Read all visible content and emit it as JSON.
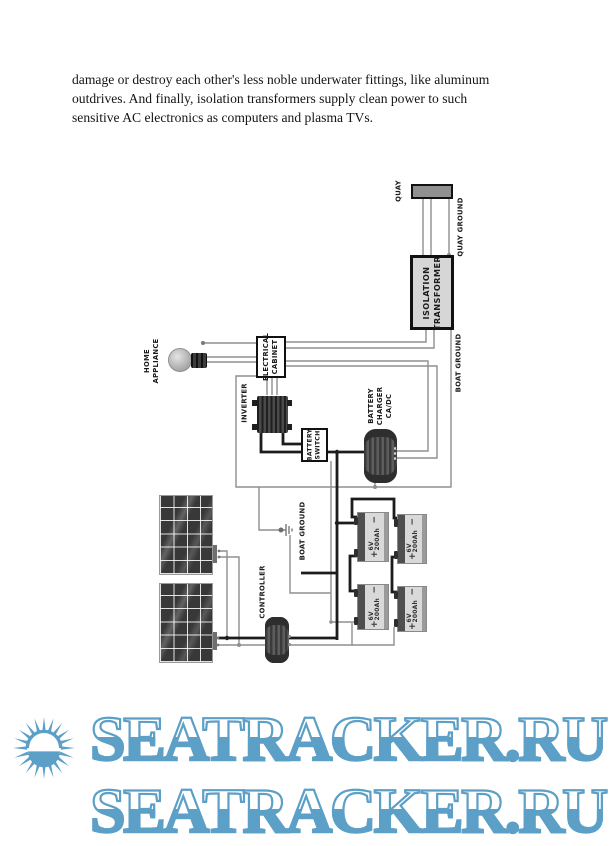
{
  "document": {
    "paragraph_lines": [
      "damage or destroy each other's less noble underwater fittings, like aluminum",
      "outdrives. And finally, isolation transformers supply clean power to such",
      "sensitive AC electronics as computers and plasma TVs."
    ]
  },
  "diagram": {
    "labels": {
      "quay": "QUAY",
      "quay_ground": "QUAY GROUND",
      "isolation_transformer": "ISOLATION\nTRANSFORMER",
      "boat_ground_shore": "BOAT GROUND",
      "electrical_cabinet": "ELECTRICAL\nCABINET",
      "home_appliance": "HOME\nAPPLIANCE",
      "inverter": "INVERTER",
      "battery_switch": "BATTERY\nSWITCH",
      "battery_charger": "BATTERY\nCHARGER\nCA/DC",
      "controller": "CONTROLLER",
      "boat_ground_house": "BOAT GROUND"
    },
    "battery_signs": {
      "plus": "+",
      "minus": "−"
    },
    "batteries": [
      {
        "label": "6V 200Ah"
      },
      {
        "label": "6V 200Ah"
      },
      {
        "label": "6V 200Ah"
      },
      {
        "label": "6V 200Ah"
      }
    ]
  },
  "watermark": {
    "text": "SEATRACKER.RU",
    "color": "#5c9fc7"
  }
}
